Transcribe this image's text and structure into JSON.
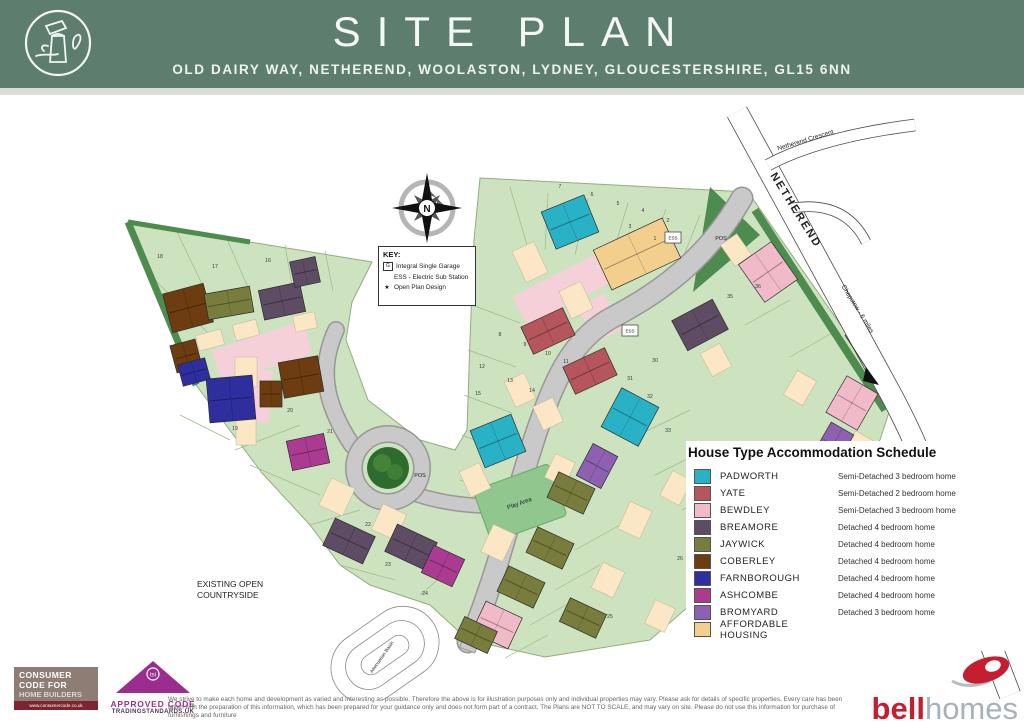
{
  "header": {
    "bg": "#5d7d6f",
    "title": "SITE PLAN",
    "address": "OLD DAIRY WAY, NETHEREND, WOOLASTON, LYDNEY, GLOUCESTERSHIRE, GL15 6NN"
  },
  "key_box": {
    "title": "KEY:",
    "items": [
      {
        "symbol": "G",
        "boxed": true,
        "label": "Integral Single Garage"
      },
      {
        "symbol": "",
        "boxed": false,
        "label": "ESS - Electric Sub Station"
      },
      {
        "symbol": "★",
        "boxed": false,
        "label": "Open Plan Design"
      }
    ]
  },
  "legend": {
    "title": "House Type Accommodation Schedule",
    "items": [
      {
        "name": "PADWORTH",
        "desc": "Semi-Detached 3 bedroom home",
        "color": "#29b2c6"
      },
      {
        "name": "YATE",
        "desc": "Semi-Detached 2 bedroom home",
        "color": "#b5565c"
      },
      {
        "name": "BEWDLEY",
        "desc": "Semi-Detached 3 bedroom home",
        "color": "#f1bac9"
      },
      {
        "name": "BREAMORE",
        "desc": "Detached 4 bedroom home",
        "color": "#5e4b64"
      },
      {
        "name": "JAYWICK",
        "desc": "Detached 4 bedroom home",
        "color": "#787d3d"
      },
      {
        "name": "COBERLEY",
        "desc": "Detached 4 bedroom home",
        "color": "#6d3c10"
      },
      {
        "name": "FARNBOROUGH",
        "desc": "Detached 4 bedroom home",
        "color": "#2e2e9e"
      },
      {
        "name": "ASHCOMBE",
        "desc": "Detached 4 bedroom home",
        "color": "#aa3b91"
      },
      {
        "name": "BROMYARD",
        "desc": "Detached 3 bedroom home",
        "color": "#8e60b1"
      },
      {
        "name": "AFFORDABLE HOUSING",
        "desc": "",
        "color": "#f3cf8e"
      }
    ]
  },
  "map": {
    "colors": {
      "site": "#cde3bf",
      "site_edge": "#8fae7e",
      "boundary": "#9cb88c",
      "dark": "#4e8b4e",
      "pink_drive": "#f6d0d8",
      "road": "#c9c9c9",
      "road_edge": "#979797",
      "white_road": "#ffffff",
      "white_road_edge": "#4a4a4a",
      "play": "#8fc78f",
      "play_edge": "#6fae6f",
      "drive": "#fbe7c6",
      "drive_edge": "#c2b394",
      "tree1": "#2e6b2e",
      "tree2": "#4a8a3c",
      "basin": "#8a8a8a"
    },
    "house_colors": {
      "padworth": "#29b2c6",
      "yate": "#b5565c",
      "bewdley": "#f1bac9",
      "breamore": "#5e4b64",
      "jaywick": "#787d3d",
      "coberley": "#6d3c10",
      "farnborough": "#2e2e9e",
      "ashcombe": "#aa3b91",
      "bromyard": "#8e60b1",
      "afford": "#f3cf8e"
    },
    "site_outline": "128,127 372,167 352,207 346,245 368,305 420,345 455,355 467,335 470,245 474,145 480,83 748,97 893,305 880,345 650,545 545,562 468,545 430,510 370,490 340,470 310,430 262,378 196,290",
    "pos_triangle": "710,92 760,140 693,197",
    "dark_strips": [
      {
        "d": "M128,127 L196,290",
        "w": 7
      },
      {
        "d": "M128,127 L250,147",
        "w": 5
      },
      {
        "d": "M755,115 L885,315",
        "w": 8
      }
    ],
    "boundaries": [
      [
        176,
        135,
        205,
        195
      ],
      [
        226,
        142,
        250,
        197
      ],
      [
        285,
        150,
        292,
        190
      ],
      [
        325,
        156,
        333,
        196
      ],
      [
        150,
        180,
        215,
        245
      ],
      [
        180,
        320,
        230,
        345
      ],
      [
        235,
        355,
        300,
        330
      ],
      [
        250,
        370,
        320,
        400
      ],
      [
        310,
        430,
        360,
        415
      ],
      [
        340,
        470,
        395,
        485
      ],
      [
        420,
        500,
        455,
        470
      ],
      [
        510,
        92,
        527,
        150
      ],
      [
        548,
        98,
        545,
        155
      ],
      [
        588,
        103,
        575,
        160
      ],
      [
        628,
        108,
        610,
        168
      ],
      [
        666,
        114,
        645,
        175
      ],
      [
        700,
        120,
        676,
        180
      ],
      [
        472,
        210,
        520,
        228
      ],
      [
        468,
        255,
        516,
        272
      ],
      [
        464,
        300,
        512,
        318
      ],
      [
        462,
        340,
        508,
        358
      ],
      [
        460,
        385,
        505,
        402
      ],
      [
        628,
        345,
        690,
        315
      ],
      [
        655,
        380,
        715,
        350
      ],
      [
        682,
        415,
        742,
        385
      ],
      [
        710,
        450,
        770,
        420
      ],
      [
        738,
        485,
        798,
        455
      ],
      [
        766,
        520,
        826,
        490
      ],
      [
        620,
        430,
        575,
        455
      ],
      [
        600,
        470,
        555,
        495
      ],
      [
        575,
        505,
        530,
        530
      ],
      [
        548,
        540,
        505,
        563
      ],
      [
        745,
        230,
        790,
        205
      ],
      [
        790,
        262,
        832,
        238
      ]
    ],
    "pink_drives": [
      [
        262,
        257,
        95,
        34,
        -18
      ],
      [
        258,
        301,
        26,
        52,
        5
      ],
      [
        577,
        187,
        128,
        32,
        -27
      ],
      [
        600,
        223,
        30,
        40,
        -27
      ]
    ],
    "grey_roads": [
      {
        "d": "M742,103 C705,167 655,200 615,221 C572,243 555,285 539,330 C520,383 505,450 488,497 C478,527 472,541 468,547",
        "w": 20
      },
      {
        "d": "M336,235 C320,270 322,305 352,350",
        "w": 15
      },
      {
        "d": "M412,398 C445,410 490,414 526,409",
        "w": 13
      }
    ],
    "loop": {
      "cx": 388,
      "cy": 373,
      "r": 34,
      "w": 15
    },
    "hammerhead": [
      472,
      542,
      28,
      16,
      -70
    ],
    "white_roads": [
      {
        "d": "M737,17 L893,303 C910,335 930,380 945,430 L1010,600",
        "w": 21
      },
      {
        "d": "M768,70 Q820,42 915,30",
        "w": 11
      },
      {
        "d": "M792,113 Q845,105 866,147",
        "w": 9
      }
    ],
    "arrow_line": "M845,240 L872,282",
    "arrow_head": "866,272 879,290 863,286",
    "play_area": [
      520,
      408,
      80,
      55,
      -20
    ],
    "tree": {
      "cx": 388,
      "cy": 373,
      "r": 21
    },
    "basin": {
      "cx": 385,
      "cy": 560,
      "rot": -35,
      "rings": [
        [
          116,
          72
        ],
        [
          86,
          46
        ],
        [
          54,
          20
        ]
      ]
    },
    "ess_boxes": [
      [
        673,
        143
      ],
      [
        630,
        236
      ]
    ],
    "ess_label": "ESS",
    "drives": [
      [
        210,
        245,
        26,
        16,
        -15
      ],
      [
        246,
        235,
        24,
        16,
        -15
      ],
      [
        305,
        227,
        22,
        16,
        -12
      ],
      [
        246,
        277,
        22,
        30,
        0
      ],
      [
        337,
        402,
        26,
        30,
        25
      ],
      [
        389,
        427,
        26,
        28,
        25
      ],
      [
        246,
        337,
        20,
        26,
        0
      ],
      [
        530,
        167,
        24,
        34,
        -25
      ],
      [
        576,
        205,
        24,
        30,
        -25
      ],
      [
        520,
        295,
        22,
        28,
        -25
      ],
      [
        548,
        319,
        22,
        26,
        -25
      ],
      [
        475,
        385,
        22,
        28,
        -25
      ],
      [
        498,
        448,
        24,
        30,
        25
      ],
      [
        560,
        375,
        22,
        26,
        25
      ],
      [
        635,
        425,
        24,
        30,
        25
      ],
      [
        608,
        485,
        24,
        28,
        25
      ],
      [
        676,
        393,
        22,
        28,
        28
      ],
      [
        736,
        403,
        24,
        30,
        28
      ],
      [
        716,
        265,
        22,
        26,
        -28
      ],
      [
        736,
        155,
        20,
        26,
        -35
      ],
      [
        800,
        293,
        22,
        28,
        30
      ],
      [
        858,
        352,
        20,
        26,
        30
      ],
      [
        660,
        521,
        22,
        26,
        25
      ]
    ],
    "houses": [
      [
        188,
        213,
        -15,
        42,
        40,
        "coberley"
      ],
      [
        229,
        208,
        -10,
        46,
        26,
        "jaywick"
      ],
      [
        282,
        206,
        -12,
        42,
        30,
        "breamore"
      ],
      [
        305,
        177,
        -12,
        26,
        26,
        "breamore"
      ],
      [
        186,
        261,
        -15,
        26,
        28,
        "coberley"
      ],
      [
        194,
        277,
        -15,
        28,
        22,
        "farnborough"
      ],
      [
        231,
        304,
        -5,
        46,
        44,
        "farnborough"
      ],
      [
        271,
        299,
        0,
        22,
        26,
        "coberley"
      ],
      [
        301,
        282,
        -10,
        40,
        36,
        "coberley"
      ],
      [
        308,
        357,
        -12,
        38,
        30,
        "ashcombe"
      ],
      [
        349,
        446,
        25,
        44,
        30,
        "breamore"
      ],
      [
        411,
        452,
        25,
        44,
        30,
        "breamore"
      ],
      [
        443,
        471,
        25,
        34,
        30,
        "ashcombe"
      ],
      [
        570,
        127,
        -22,
        46,
        40,
        "padworth"
      ],
      [
        637,
        159,
        -25,
        76,
        44,
        "afford"
      ],
      [
        548,
        236,
        -25,
        46,
        30,
        "yate"
      ],
      [
        590,
        276,
        -25,
        46,
        30,
        "yate"
      ],
      [
        498,
        346,
        -22,
        44,
        40,
        "padworth"
      ],
      [
        768,
        177,
        -35,
        40,
        46,
        "bewdley"
      ],
      [
        700,
        230,
        -28,
        46,
        34,
        "breamore"
      ],
      [
        630,
        322,
        28,
        42,
        44,
        "padworth"
      ],
      [
        597,
        371,
        28,
        28,
        36,
        "bromyard"
      ],
      [
        571,
        398,
        25,
        40,
        28,
        "jaywick"
      ],
      [
        550,
        453,
        25,
        40,
        28,
        "jaywick"
      ],
      [
        521,
        492,
        25,
        40,
        28,
        "jaywick"
      ],
      [
        583,
        523,
        25,
        40,
        26,
        "jaywick"
      ],
      [
        497,
        530,
        25,
        40,
        34,
        "bewdley"
      ],
      [
        476,
        540,
        25,
        36,
        24,
        "jaywick"
      ],
      [
        852,
        308,
        30,
        36,
        42,
        "bewdley"
      ],
      [
        833,
        350,
        30,
        26,
        38,
        "bromyard"
      ],
      [
        790,
        420,
        28,
        44,
        30,
        "jaywick"
      ],
      [
        763,
        435,
        28,
        44,
        30,
        "jaywick"
      ]
    ],
    "plot_numbers": [
      [
        16,
        268,
        167
      ],
      [
        17,
        215,
        173
      ],
      [
        18,
        160,
        163
      ],
      [
        19,
        235,
        335
      ],
      [
        20,
        290,
        317
      ],
      [
        21,
        330,
        338
      ],
      [
        22,
        368,
        431
      ],
      [
        23,
        388,
        471
      ],
      [
        24,
        425,
        500
      ],
      [
        7,
        560,
        93
      ],
      [
        6,
        592,
        101
      ],
      [
        5,
        618,
        110
      ],
      [
        4,
        643,
        117
      ],
      [
        3,
        630,
        133
      ],
      [
        2,
        668,
        127
      ],
      [
        1,
        655,
        145
      ],
      [
        8,
        500,
        241
      ],
      [
        9,
        525,
        251
      ],
      [
        10,
        548,
        260
      ],
      [
        11,
        566,
        268
      ],
      [
        12,
        482,
        273
      ],
      [
        13,
        510,
        287
      ],
      [
        14,
        532,
        297
      ],
      [
        15,
        478,
        300
      ],
      [
        25,
        610,
        523
      ],
      [
        26,
        680,
        465
      ],
      [
        27,
        782,
        427
      ],
      [
        28,
        840,
        377
      ],
      [
        29,
        872,
        361
      ],
      [
        30,
        655,
        267
      ],
      [
        31,
        630,
        285
      ],
      [
        32,
        650,
        303
      ],
      [
        33,
        668,
        337
      ],
      [
        34,
        700,
        353
      ],
      [
        35,
        730,
        203
      ],
      [
        36,
        758,
        193
      ]
    ],
    "labels": [
      {
        "t": "NETHEREND",
        "x": 793,
        "y": 117,
        "r": 58,
        "s": 11,
        "b": 1,
        "ls": 2
      },
      {
        "t": "Netherend Crescent",
        "x": 806,
        "y": 47,
        "r": -17,
        "s": 6.5,
        "b": 0,
        "ls": 0
      },
      {
        "t": "Chepstow - 6 miles",
        "x": 856,
        "y": 215,
        "r": 58,
        "s": 6.5,
        "b": 0,
        "ls": 0
      },
      {
        "t": "POS",
        "x": 721,
        "y": 145,
        "r": 0,
        "s": 5.5,
        "b": 0,
        "ls": 0
      },
      {
        "t": "POS",
        "x": 420,
        "y": 382,
        "r": 0,
        "s": 5.5,
        "b": 0,
        "ls": 0
      },
      {
        "t": "Play Area",
        "x": 520,
        "y": 410,
        "r": -20,
        "s": 6,
        "b": 0,
        "ls": 0
      },
      {
        "t": "Attenuation Basin",
        "x": 383,
        "y": 563,
        "r": -55,
        "s": 4.8,
        "b": 0,
        "ls": 0
      },
      {
        "t": "EXISTING OPEN",
        "x": 197,
        "y": 492,
        "r": 0,
        "s": 8.5,
        "b": 0,
        "ls": 0,
        "a": "start"
      },
      {
        "t": "COUNTRYSIDE",
        "x": 197,
        "y": 503,
        "r": 0,
        "s": 8.5,
        "b": 0,
        "ls": 0,
        "a": "start"
      }
    ]
  },
  "footer": {
    "disclaimer1": "We strive to make each home and development as varied and interesting as possible. Therefore the above is for illustration purposes only and individual properties may vary. Please ask for details of specific properties. Every care has been taken with the preparation of this information, which has been prepared for your guidance only",
    "disclaimer2": "and does not form part of a contract. The Plans are NOT TO SCALE, and may vary on site. Please do not use this information for purchase of furnishings and furniture",
    "consumer_code": {
      "l1": "CONSUMER",
      "l2": "CODE FOR",
      "l3": "HOME BUILDERS",
      "url": "www.consumercode.co.uk"
    },
    "approved_code": {
      "line1": "APPROVED CODE",
      "line2": "TRADINGSTANDARDS.UK"
    },
    "bell": {
      "bold": "bell",
      "light": "homes"
    }
  }
}
